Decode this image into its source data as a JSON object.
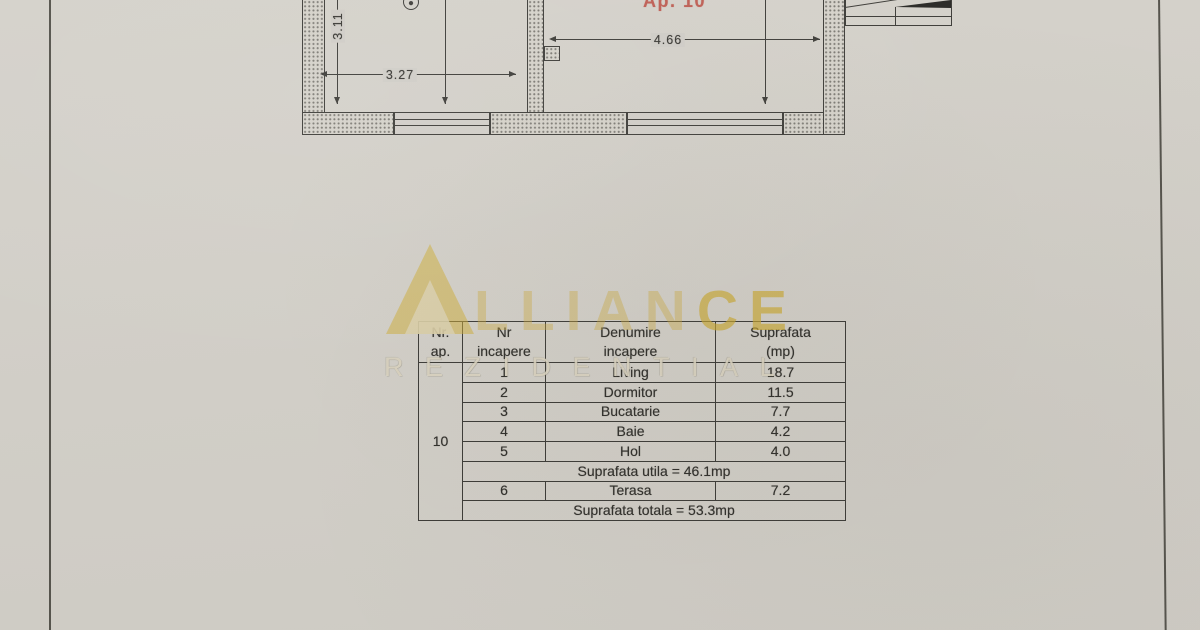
{
  "floor_plan": {
    "apartment_label": "Ap. 10",
    "dim_left_room_width": "3.27",
    "dim_left_room_height": "3.11",
    "dim_living_width": "4.66"
  },
  "watermark": {
    "brand": "ALLIANCE",
    "brand_part_dim": "LLIAN",
    "brand_part_bright": "CE",
    "subtitle": "REZIDENTIAL",
    "gold": "#cca82d"
  },
  "area_table": {
    "headers": {
      "col1_line1": "Nr.",
      "col1_line2": "ap.",
      "col2_line1": "Nr",
      "col2_line2": "incapere",
      "col3_line1": "Denumire",
      "col3_line2": "incapere",
      "col4_line1": "Suprafata",
      "col4_line2": "(mp)"
    },
    "apartment_number": "10",
    "rows": [
      {
        "nr": "1",
        "name": "Living",
        "area": "18.7"
      },
      {
        "nr": "2",
        "name": "Dormitor",
        "area": "11.5"
      },
      {
        "nr": "3",
        "name": "Bucatarie",
        "area": "7.7"
      },
      {
        "nr": "4",
        "name": "Baie",
        "area": "4.2"
      },
      {
        "nr": "5",
        "name": "Hol",
        "area": "4.0"
      }
    ],
    "useful_area_text": "Suprafata utila = 46.1mp",
    "terrace_row": {
      "nr": "6",
      "name": "Terasa",
      "area": "7.2"
    },
    "total_area_text": "Suprafata totala = 53.3mp"
  },
  "colors": {
    "paper": "#d1cec7",
    "ink": "#3c3b37",
    "red_label": "#bf5f55",
    "watermark_gold": "#cca82d"
  }
}
